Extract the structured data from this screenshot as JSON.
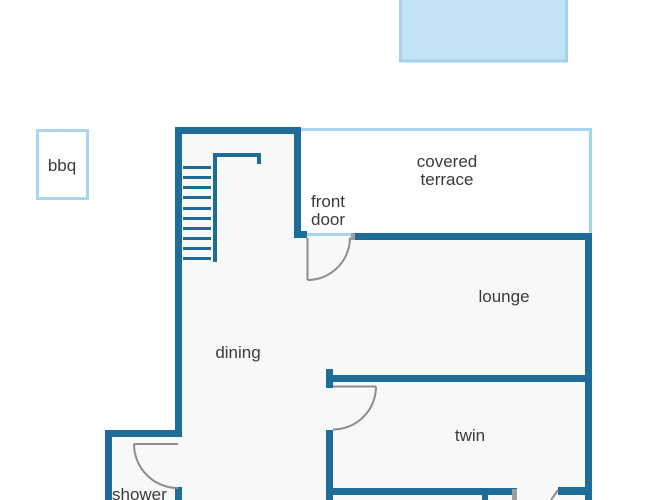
{
  "diagram": {
    "type": "floor-plan",
    "labels": {
      "bbq": "bbq",
      "covered_terrace_line1": "covered",
      "covered_terrace_line2": "terrace",
      "front_door_line1": "front",
      "front_door_line2": "door",
      "lounge": "lounge",
      "dining": "dining",
      "twin": "twin",
      "shower": "shower"
    },
    "rooms": [
      "covered terrace",
      "lounge",
      "dining",
      "twin",
      "shower"
    ],
    "outdoor_features": [
      "pool",
      "bbq"
    ],
    "colors": {
      "wall": "#1e6d99",
      "light_border": "#a9d6ec",
      "pool_fill": "#c2e3f6",
      "pool_border": "#a5d2e9",
      "floor_fill": "#f7f8f8",
      "terrace_fill": "#fdfeff",
      "door_stroke": "#8d8d8d",
      "frame_gray": "#9e9e9e",
      "text": "#3b3b3b"
    }
  }
}
